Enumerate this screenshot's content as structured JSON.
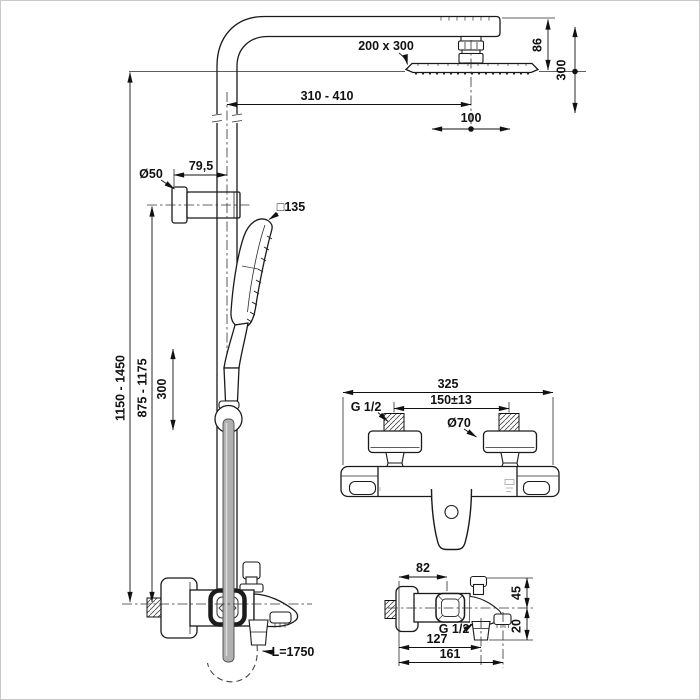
{
  "drawing_labels": {
    "overhead": {
      "head_size": "200 x 300",
      "head_height": "86",
      "vertical_travel": "300",
      "arm_reach": "310 - 410",
      "horizontal_travel": "100"
    },
    "column": {
      "bracket_diameter": "Ø50",
      "bracket_offset": "79,5",
      "handspray_size": "□135",
      "overall_height": "1150 - 1450",
      "bracket_height": "875 - 1175",
      "slide_range": "300",
      "hose_length": "L=1750"
    },
    "mixer_front": {
      "overall_width": "325",
      "inlet_centers": "150±13",
      "inlet_thread": "G 1/2",
      "escutcheon_diameter": "Ø70"
    },
    "mixer_side": {
      "flange_to_diverter": "82",
      "above_center": "45",
      "below_center": "20",
      "outlet_thread": "G 1/2",
      "flange_to_outlet": "127",
      "overall_depth": "161"
    }
  }
}
